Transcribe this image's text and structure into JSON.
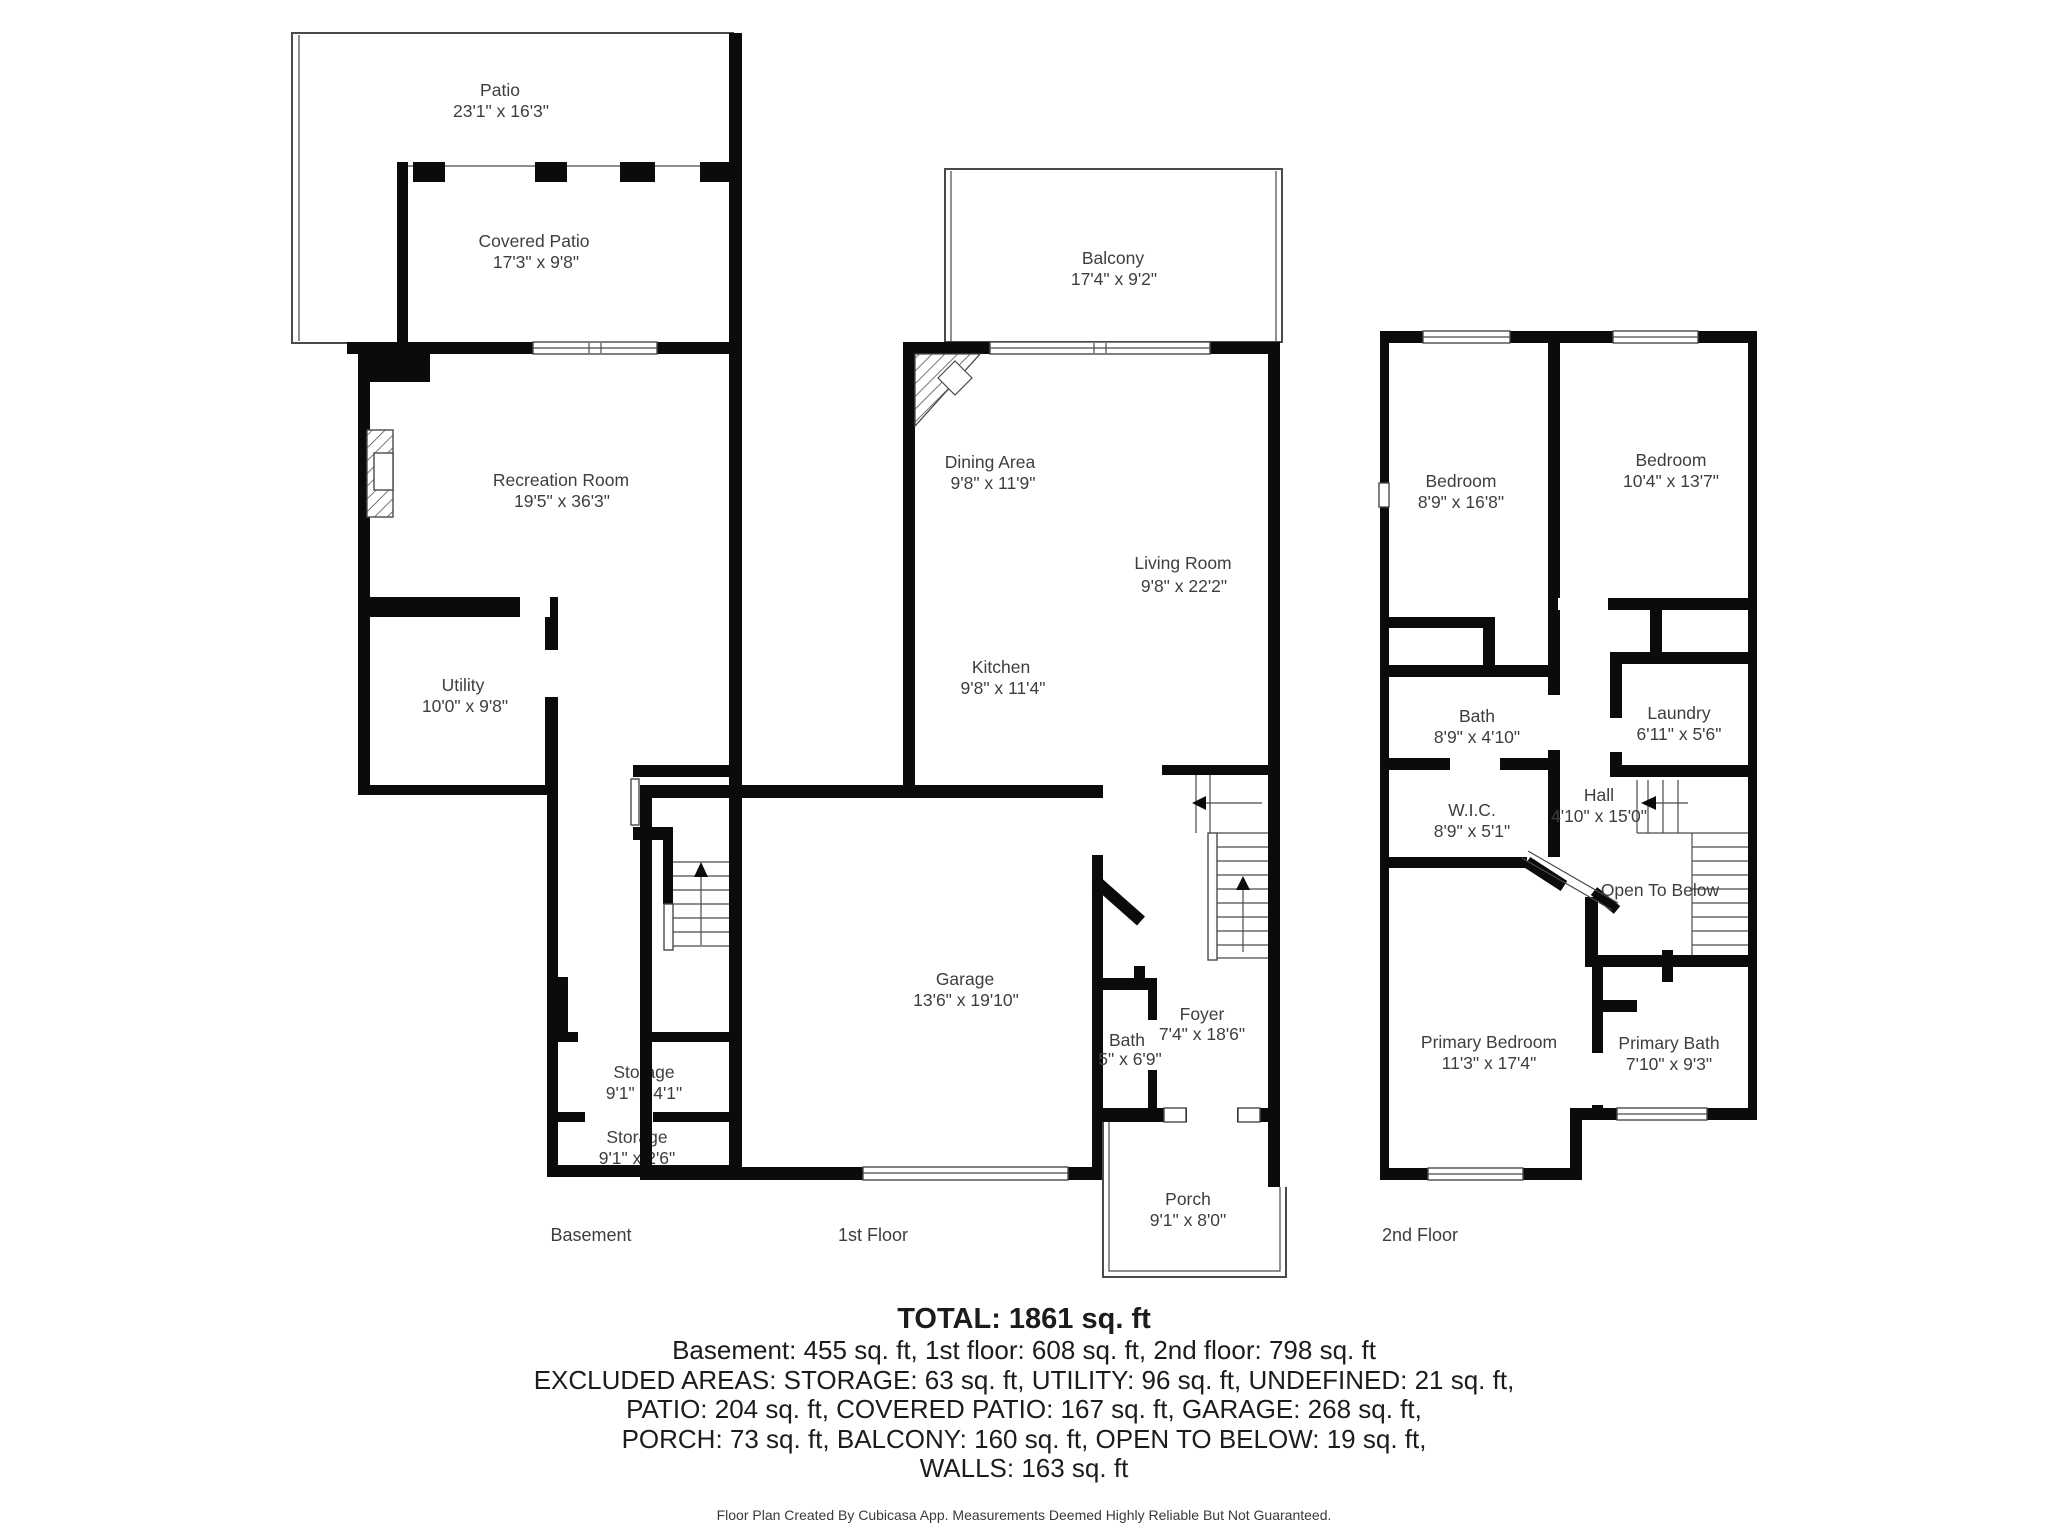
{
  "colors": {
    "wall": "#0b0b0b",
    "outline": "#4a4a4a",
    "text": "#3e3e3e"
  },
  "floors": {
    "basement": {
      "label": "Basement",
      "rooms": {
        "patio": {
          "name": "Patio",
          "dims": "23'1\" x 16'3\""
        },
        "covered_patio": {
          "name": "Covered Patio",
          "dims": "17'3\" x 9'8\""
        },
        "recreation_room": {
          "name": "Recreation Room",
          "dims": "19'5\" x 36'3\""
        },
        "utility": {
          "name": "Utility",
          "dims": "10'0\" x 9'8\""
        },
        "storage_1": {
          "name": "Storage",
          "dims": "9'1\" x 4'1\""
        },
        "storage_2": {
          "name": "Storage",
          "dims": "9'1\" x 2'6\""
        }
      }
    },
    "first": {
      "label": "1st Floor",
      "rooms": {
        "balcony": {
          "name": "Balcony",
          "dims": "17'4\" x 9'2\""
        },
        "dining_area": {
          "name": "Dining Area",
          "dims": "9'8\" x 11'9\""
        },
        "living_room": {
          "name": "Living Room",
          "dims": "9'8\" x 22'2\""
        },
        "kitchen": {
          "name": "Kitchen",
          "dims": "9'8\" x 11'4\""
        },
        "garage": {
          "name": "Garage",
          "dims": "13'6\" x 19'10\""
        },
        "bath": {
          "name": "Bath",
          "dims": "5\" x 6'9\""
        },
        "foyer": {
          "name": "Foyer",
          "dims": "7'4\" x 18'6\""
        },
        "porch": {
          "name": "Porch",
          "dims": "9'1\" x 8'0\""
        }
      }
    },
    "second": {
      "label": "2nd Floor",
      "rooms": {
        "bedroom_1": {
          "name": "Bedroom",
          "dims": "8'9\" x 16'8\""
        },
        "bedroom_2": {
          "name": "Bedroom",
          "dims": "10'4\" x 13'7\""
        },
        "bath": {
          "name": "Bath",
          "dims": "8'9\" x 4'10\""
        },
        "laundry": {
          "name": "Laundry",
          "dims": "6'11\" x 5'6\""
        },
        "wic": {
          "name": "W.I.C.",
          "dims": "8'9\" x 5'1\""
        },
        "hall": {
          "name": "Hall",
          "dims": "4'10\" x 15'0\""
        },
        "open_to_below": {
          "name": "Open To Below"
        },
        "primary_bedroom": {
          "name": "Primary Bedroom",
          "dims": "11'3\" x 17'4\""
        },
        "primary_bath": {
          "name": "Primary Bath",
          "dims": "7'10\" x 9'3\""
        }
      }
    }
  },
  "summary": {
    "total": "TOTAL: 1861 sq. ft",
    "lines": [
      "Basement: 455 sq. ft, 1st floor: 608 sq. ft, 2nd floor: 798 sq. ft",
      "EXCLUDED AREAS: STORAGE: 63 sq. ft, UTILITY: 96 sq. ft, UNDEFINED: 21 sq. ft,",
      "PATIO: 204 sq. ft, COVERED PATIO: 167 sq. ft, GARAGE: 268 sq. ft,",
      "PORCH: 73 sq. ft, BALCONY: 160 sq. ft, OPEN TO BELOW: 19 sq. ft,",
      "WALLS: 163 sq. ft"
    ]
  },
  "footer": "Floor Plan Created By Cubicasa App. Measurements Deemed Highly Reliable But Not Guaranteed."
}
